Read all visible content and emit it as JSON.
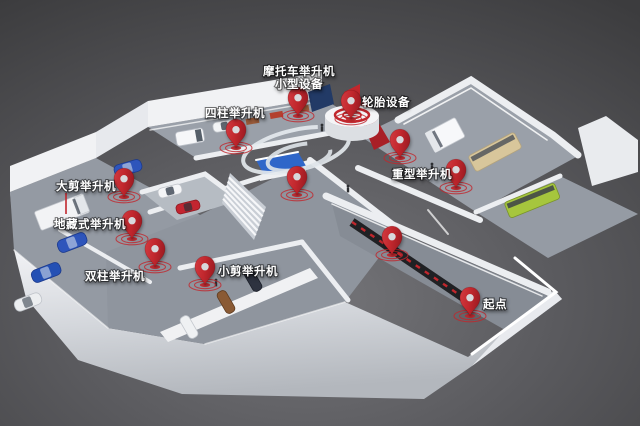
{
  "scene": {
    "description": "3D isometric facility floor map with red location pins",
    "width": 640,
    "height": 426
  },
  "colors": {
    "pin_red": "#c1272d",
    "accent_red": "#c1272d",
    "label_white": "#ffffff",
    "bg_center": "#747478",
    "bg_edge": "#3c3c3e",
    "floor_gray": "#969ca5",
    "wall_light": "#edeff2",
    "bus_green": "#a6c63d",
    "bus_tan": "#d8c69b",
    "car_blue": "#2e55bb",
    "car_red": "#c32530",
    "desk_blue": "#2f66c9",
    "walkway_dark": "#202124"
  },
  "markers": [
    {
      "name": "motorcycle-lift",
      "pin": {
        "x": 298,
        "y": 116
      },
      "label": {
        "lines": [
          "摩托车举升机",
          "小型设备"
        ],
        "x": 299,
        "y": 75,
        "anchor": "middle"
      }
    },
    {
      "name": "tire-equipment",
      "pin": {
        "x": 351,
        "y": 119
      },
      "label": {
        "lines": [
          "轮胎设备"
        ],
        "x": 362,
        "y": 106,
        "anchor": "start"
      }
    },
    {
      "name": "four-post-lift",
      "pin": {
        "x": 236,
        "y": 148
      },
      "label": {
        "lines": [
          "四柱举升机"
        ],
        "x": 235,
        "y": 117,
        "anchor": "middle"
      }
    },
    {
      "name": "center-lobby",
      "pin": {
        "x": 297,
        "y": 195
      },
      "label": null
    },
    {
      "name": "big-scissor-lift",
      "pin": {
        "x": 124,
        "y": 197
      },
      "label": {
        "lines": [
          "大剪举升机"
        ],
        "x": 86,
        "y": 190,
        "anchor": "middle"
      }
    },
    {
      "name": "in-ground-lift",
      "pin": {
        "x": 132,
        "y": 239
      },
      "label": {
        "lines": [
          "地藏式举升机"
        ],
        "x": 90,
        "y": 228,
        "anchor": "middle"
      }
    },
    {
      "name": "two-post-lift",
      "pin": {
        "x": 155,
        "y": 267
      },
      "label": {
        "lines": [
          "双柱举升机"
        ],
        "x": 115,
        "y": 280,
        "anchor": "middle"
      }
    },
    {
      "name": "small-scissor-lift",
      "pin": {
        "x": 205,
        "y": 285
      },
      "label": {
        "lines": [
          "小剪举升机"
        ],
        "x": 248,
        "y": 275,
        "anchor": "middle"
      }
    },
    {
      "name": "heavy-duty-lift-a",
      "pin": {
        "x": 400,
        "y": 158
      },
      "label": {
        "lines": [
          "重型举升机"
        ],
        "x": 422,
        "y": 178,
        "anchor": "middle"
      }
    },
    {
      "name": "heavy-duty-lift-b",
      "pin": {
        "x": 456,
        "y": 188
      },
      "label": null
    },
    {
      "name": "corridor-station",
      "pin": {
        "x": 392,
        "y": 255
      },
      "label": null
    },
    {
      "name": "start-point",
      "pin": {
        "x": 470,
        "y": 316
      },
      "label": {
        "lines": [
          "起点"
        ],
        "x": 495,
        "y": 308,
        "anchor": "middle"
      }
    }
  ]
}
